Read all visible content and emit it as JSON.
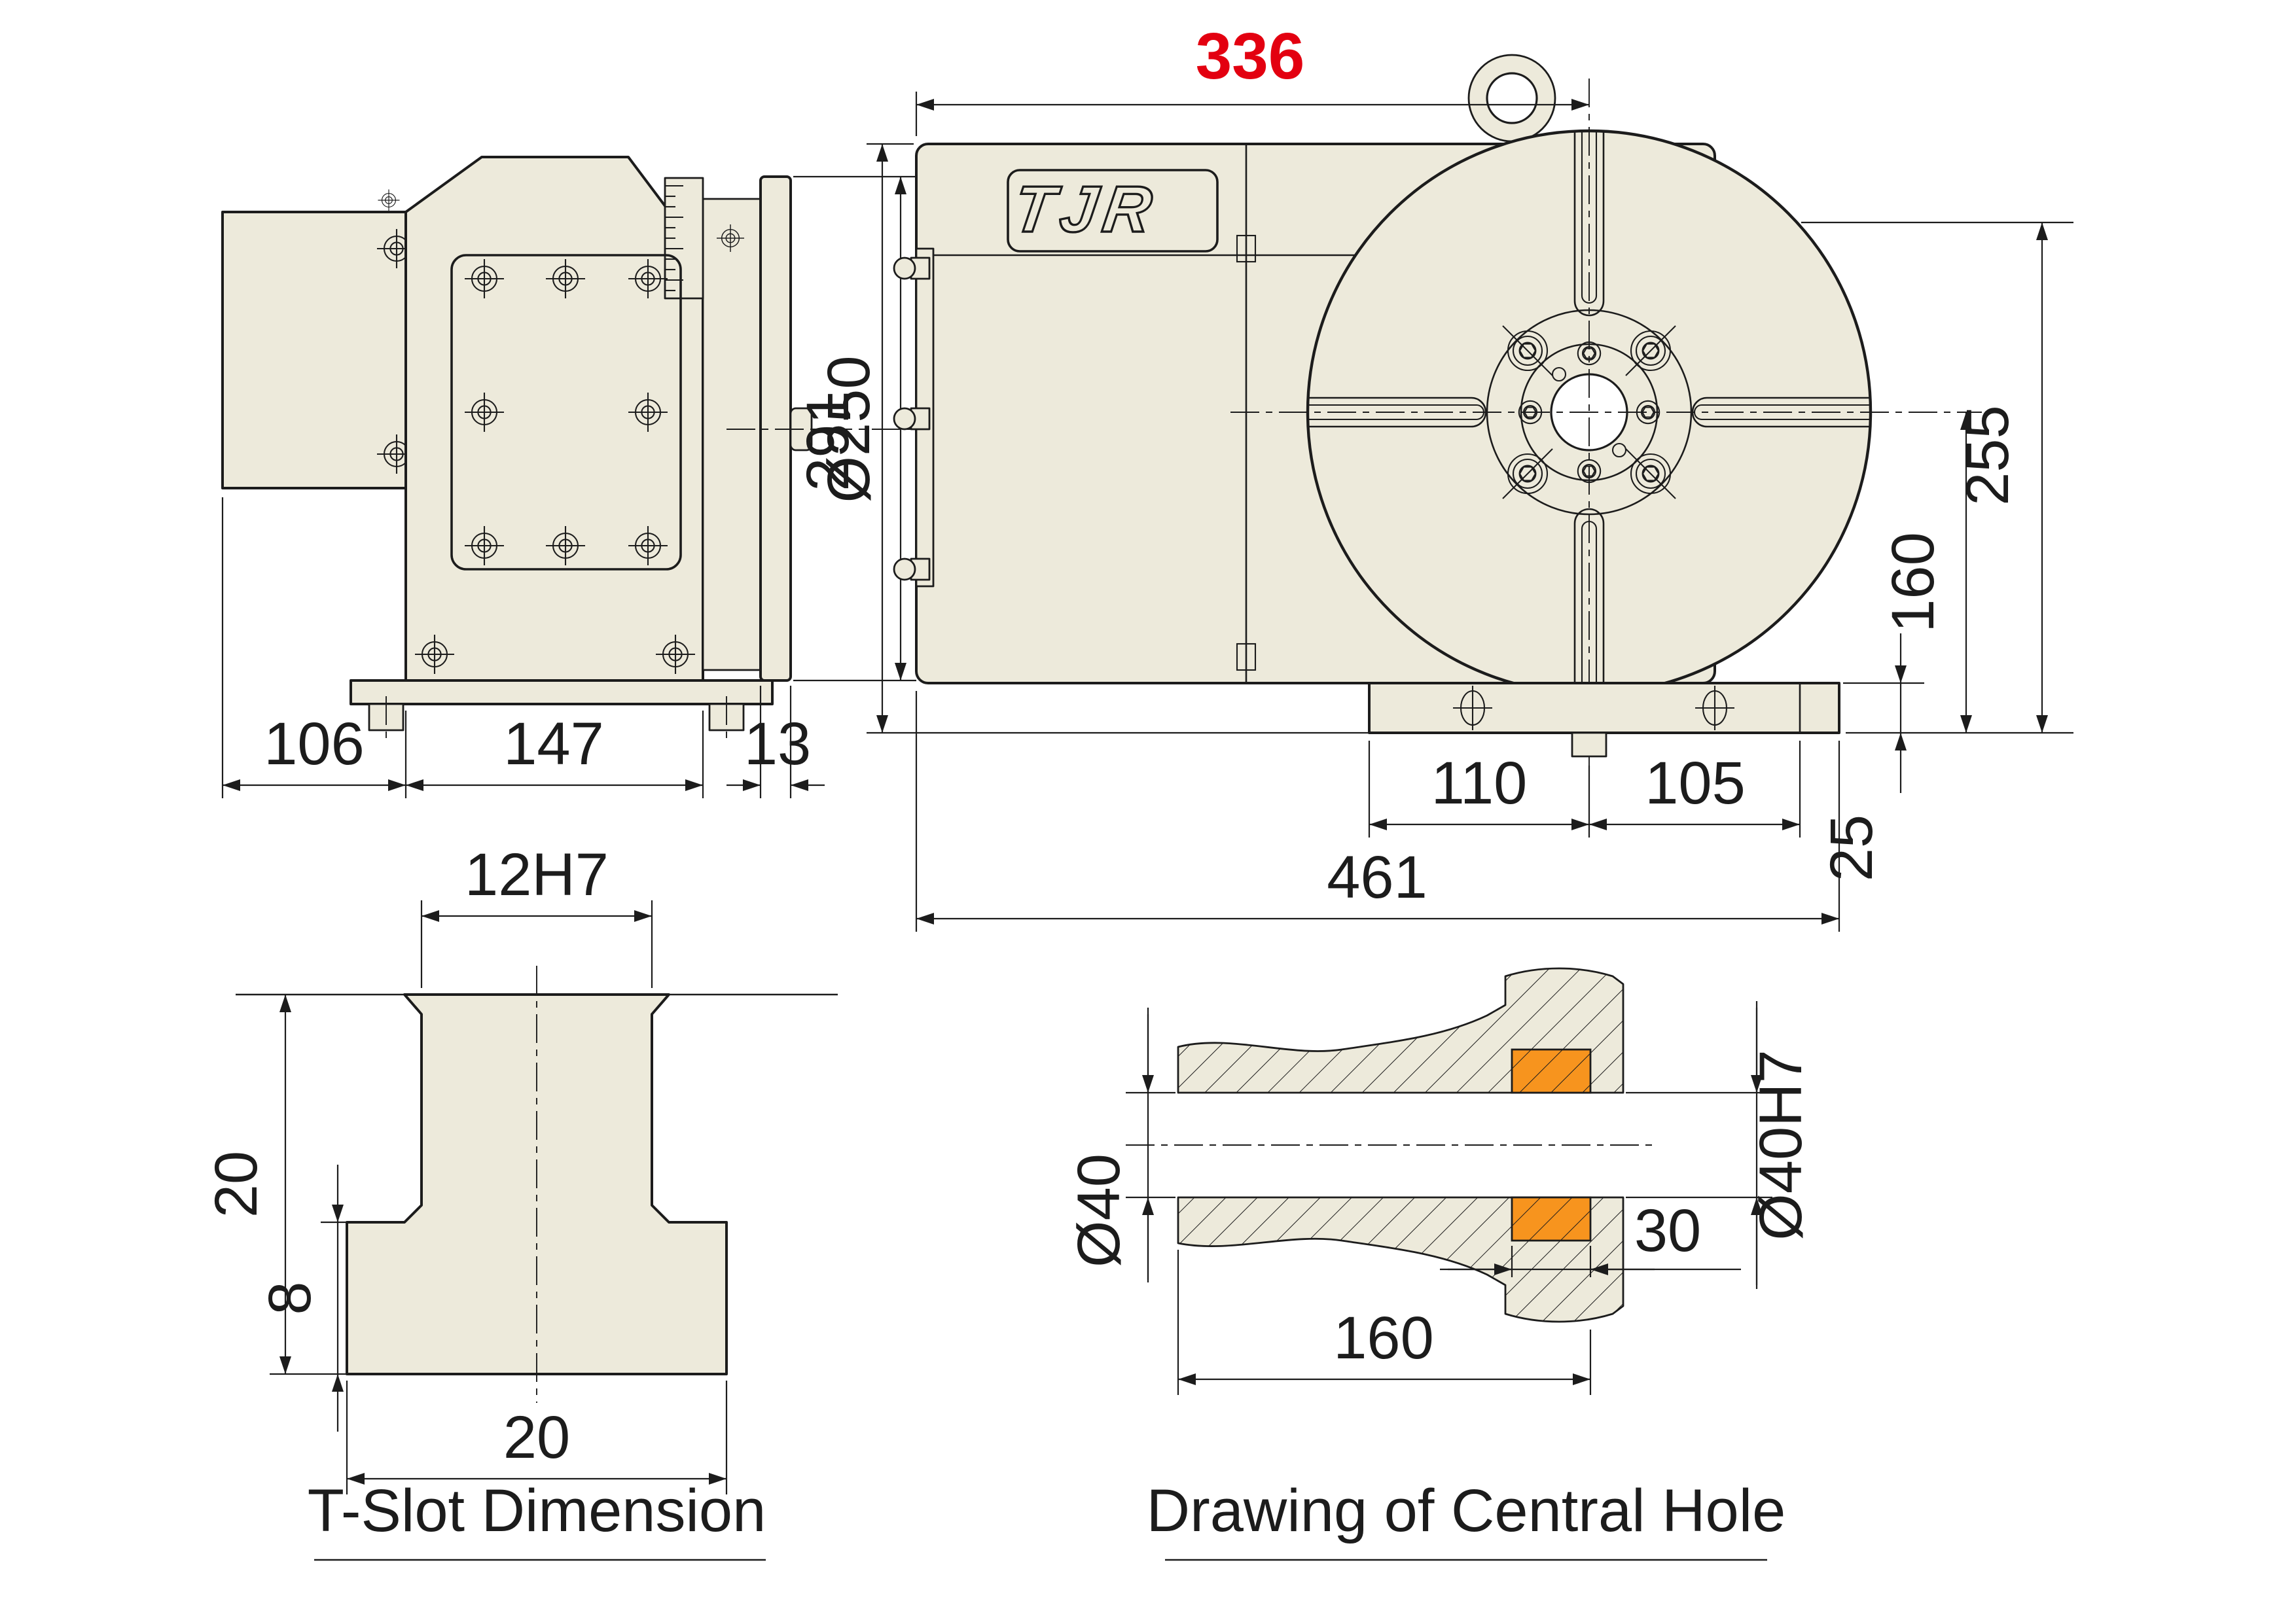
{
  "colors": {
    "background": "#ffffff",
    "body_fill": "#edeadb",
    "line": "#1c1c1c",
    "dim_red": "#e30010",
    "highlight_orange": "#f7941e"
  },
  "logo": {
    "text": "TJR"
  },
  "side_view": {
    "face_diameter": "Ø250",
    "motor_width": "106",
    "body_width": "147",
    "plate_thickness": "13"
  },
  "front_view": {
    "center_from_left": "336",
    "body_height": "291",
    "upper_height": "255",
    "center_height": "160",
    "base_height": "25",
    "slot_left": "110",
    "slot_right": "105",
    "overall_width": "461"
  },
  "tslot": {
    "title": "T-Slot Dimension",
    "slot_width": "12H7",
    "total_depth": "20",
    "base_depth": "8",
    "base_width": "20"
  },
  "central_hole": {
    "title": "Drawing of Central Hole",
    "bore_diameter": "Ø40",
    "bore_length": "160",
    "precision_length": "30",
    "precision_bore": "Ø40H7"
  }
}
